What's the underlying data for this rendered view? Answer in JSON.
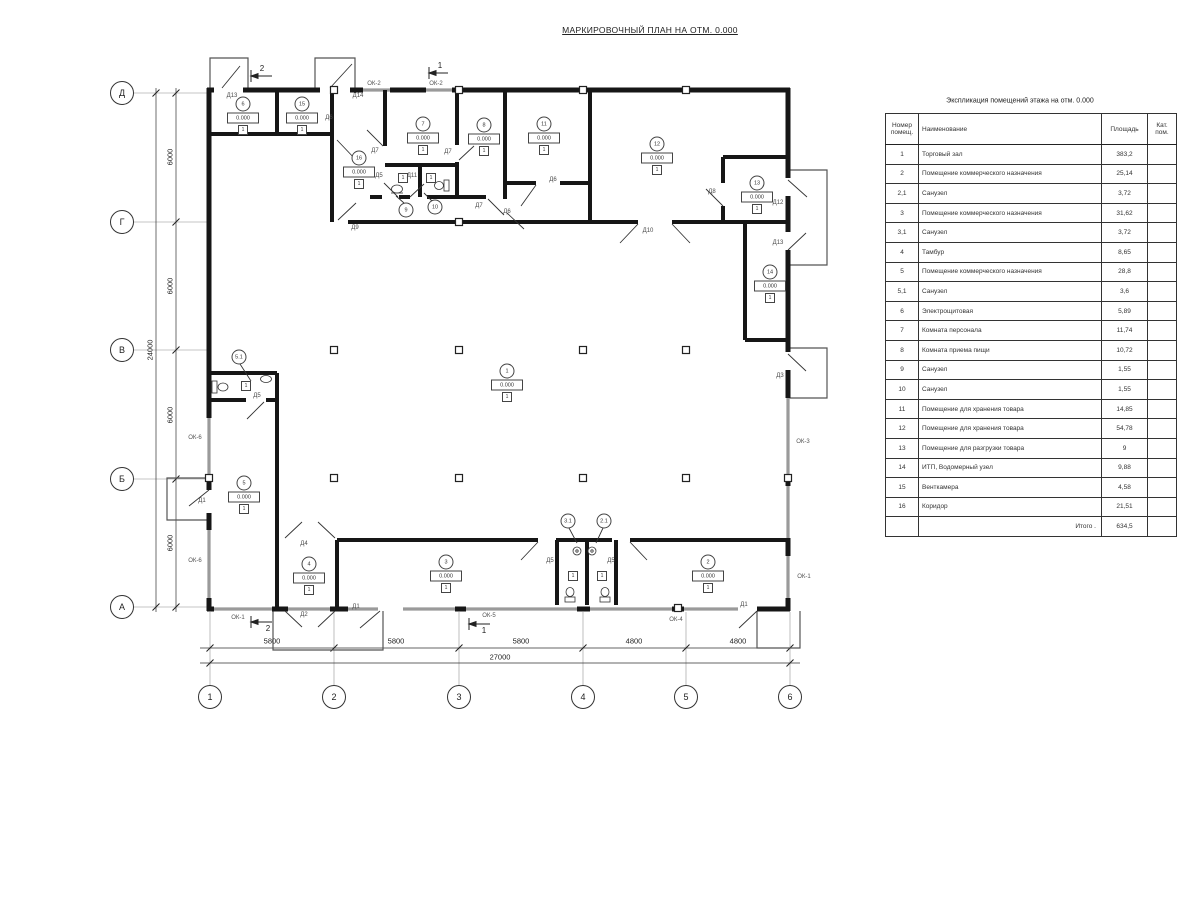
{
  "title": "МАРКИРОВОЧНЫЙ ПЛАН НА ОТМ. 0.000",
  "schedule": {
    "title": "Экспликация помещений этажа на отм. 0.000",
    "col_num": "Номер помещ.",
    "col_name": "Наименование",
    "col_area": "Площадь",
    "col_cat": "Кат. пом.",
    "rows": [
      {
        "num": "1",
        "name": "Торговый зал",
        "area": "383,2"
      },
      {
        "num": "2",
        "name": "Помещение коммерческого назначения",
        "area": "25,14"
      },
      {
        "num": "2,1",
        "name": "Санузел",
        "area": "3,72"
      },
      {
        "num": "3",
        "name": "Помещение коммерческого назначения",
        "area": "31,62"
      },
      {
        "num": "3,1",
        "name": "Санузел",
        "area": "3,72"
      },
      {
        "num": "4",
        "name": "Тамбур",
        "area": "8,65"
      },
      {
        "num": "5",
        "name": "Помещение коммерческого назначения",
        "area": "28,8"
      },
      {
        "num": "5,1",
        "name": "Санузел",
        "area": "3,6"
      },
      {
        "num": "6",
        "name": "Электрощитовая",
        "area": "5,89"
      },
      {
        "num": "7",
        "name": "Комната персонала",
        "area": "11,74"
      },
      {
        "num": "8",
        "name": "Комната приема пищи",
        "area": "10,72"
      },
      {
        "num": "9",
        "name": "Санузел",
        "area": "1,55"
      },
      {
        "num": "10",
        "name": "Санузел",
        "area": "1,55"
      },
      {
        "num": "11",
        "name": "Помещение для хранения товара",
        "area": "14,85"
      },
      {
        "num": "12",
        "name": "Помещение для хранения товара",
        "area": "54,78"
      },
      {
        "num": "13",
        "name": "Помещение для разгрузки товара",
        "area": "9"
      },
      {
        "num": "14",
        "name": "ИТП, Водомерный узел",
        "area": "9,88"
      },
      {
        "num": "15",
        "name": "Венткамера",
        "area": "4,58"
      },
      {
        "num": "16",
        "name": "Коридор",
        "area": "21,51"
      }
    ],
    "total_label": "Итого .",
    "total_value": "634,5"
  },
  "plan": {
    "elevation": "0.000",
    "floor_type": "1",
    "markers": [
      {
        "num": "6",
        "x": 243,
        "y": 104
      },
      {
        "num": "15",
        "x": 302,
        "y": 104
      },
      {
        "num": "16",
        "x": 359,
        "y": 158
      },
      {
        "num": "7",
        "x": 423,
        "y": 124
      },
      {
        "num": "8",
        "x": 484,
        "y": 125
      },
      {
        "num": "11",
        "x": 544,
        "y": 124
      },
      {
        "num": "12",
        "x": 657,
        "y": 144
      },
      {
        "num": "13",
        "x": 757,
        "y": 183
      },
      {
        "num": "14",
        "x": 770,
        "y": 272
      },
      {
        "num": "1",
        "x": 507,
        "y": 371
      },
      {
        "num": "5",
        "x": 244,
        "y": 483
      },
      {
        "num": "4",
        "x": 309,
        "y": 564
      },
      {
        "num": "3",
        "x": 446,
        "y": 562
      },
      {
        "num": "2",
        "x": 708,
        "y": 562
      }
    ],
    "leader_markers": [
      {
        "num": "5.1",
        "x": 239,
        "y": 357
      },
      {
        "num": "9",
        "x": 406,
        "y": 210
      },
      {
        "num": "10",
        "x": 435,
        "y": 207
      },
      {
        "num": "3.1",
        "x": 568,
        "y": 521
      },
      {
        "num": "2.1",
        "x": 604,
        "y": 521
      }
    ],
    "type_boxes": [
      {
        "x": 403,
        "y": 178
      },
      {
        "x": 431,
        "y": 178
      },
      {
        "x": 246,
        "y": 386
      },
      {
        "x": 573,
        "y": 576
      },
      {
        "x": 602,
        "y": 576
      }
    ],
    "door_labels": [
      {
        "t": "Д13",
        "x": 232,
        "y": 96
      },
      {
        "t": "Д14",
        "x": 358,
        "y": 96
      },
      {
        "t": "Д6",
        "x": 329,
        "y": 118
      },
      {
        "t": "Д7",
        "x": 375,
        "y": 151
      },
      {
        "t": "Д7",
        "x": 448,
        "y": 152
      },
      {
        "t": "Д7",
        "x": 479,
        "y": 206
      },
      {
        "t": "Д6",
        "x": 553,
        "y": 180
      },
      {
        "t": "Д6",
        "x": 507,
        "y": 212
      },
      {
        "t": "Д5",
        "x": 379,
        "y": 176
      },
      {
        "t": "Д11",
        "x": 412,
        "y": 176
      },
      {
        "t": "Д9",
        "x": 355,
        "y": 228
      },
      {
        "t": "Д10",
        "x": 648,
        "y": 231
      },
      {
        "t": "Д8",
        "x": 712,
        "y": 192
      },
      {
        "t": "Д12",
        "x": 778,
        "y": 203
      },
      {
        "t": "Д13",
        "x": 778,
        "y": 243
      },
      {
        "t": "Д3",
        "x": 780,
        "y": 376
      },
      {
        "t": "Д5",
        "x": 257,
        "y": 396
      },
      {
        "t": "Д1",
        "x": 202,
        "y": 501
      },
      {
        "t": "Д4",
        "x": 304,
        "y": 544
      },
      {
        "t": "Д2",
        "x": 304,
        "y": 615
      },
      {
        "t": "Д1",
        "x": 356,
        "y": 607
      },
      {
        "t": "Д5",
        "x": 550,
        "y": 561
      },
      {
        "t": "Д5",
        "x": 611,
        "y": 561
      },
      {
        "t": "Д1",
        "x": 744,
        "y": 605
      }
    ],
    "window_labels": [
      {
        "t": "ОК-2",
        "x": 374,
        "y": 84
      },
      {
        "t": "ОК-2",
        "x": 436,
        "y": 84
      },
      {
        "t": "ОК-6",
        "x": 195,
        "y": 438
      },
      {
        "t": "ОК-6",
        "x": 195,
        "y": 561
      },
      {
        "t": "ОК-3",
        "x": 803,
        "y": 442
      },
      {
        "t": "ОК-1",
        "x": 804,
        "y": 577
      },
      {
        "t": "ОК-1",
        "x": 238,
        "y": 618
      },
      {
        "t": "ОК-5",
        "x": 489,
        "y": 616
      },
      {
        "t": "ОК-4",
        "x": 676,
        "y": 620
      }
    ],
    "axis_rows": [
      {
        "label": "Д",
        "y": 93
      },
      {
        "label": "Г",
        "y": 222
      },
      {
        "label": "В",
        "y": 350
      },
      {
        "label": "Б",
        "y": 479
      },
      {
        "label": "А",
        "y": 607
      }
    ],
    "axis_cols": [
      {
        "label": "1",
        "x": 210
      },
      {
        "label": "2",
        "x": 334
      },
      {
        "label": "3",
        "x": 459
      },
      {
        "label": "4",
        "x": 583
      },
      {
        "label": "5",
        "x": 686
      },
      {
        "label": "6",
        "x": 790
      }
    ],
    "dim_left": [
      {
        "label": "6000",
        "y": 157
      },
      {
        "label": "6000",
        "y": 286
      },
      {
        "label": "6000",
        "y": 415
      },
      {
        "label": "6000",
        "y": 543
      }
    ],
    "dim_left_total": {
      "label": "24000",
      "y": 350
    },
    "dim_bottom": [
      {
        "label": "5800",
        "x": 272
      },
      {
        "label": "5800",
        "x": 396
      },
      {
        "label": "5800",
        "x": 521
      },
      {
        "label": "4800",
        "x": 634
      },
      {
        "label": "4800",
        "x": 738
      }
    ],
    "dim_bottom_total": {
      "label": "27000",
      "x": 500
    },
    "section_marks": [
      {
        "label": "2",
        "x": 262,
        "y": 69
      },
      {
        "label": "1",
        "x": 440,
        "y": 66
      },
      {
        "label": "2",
        "x": 268,
        "y": 629
      },
      {
        "label": "1",
        "x": 484,
        "y": 631
      }
    ]
  }
}
